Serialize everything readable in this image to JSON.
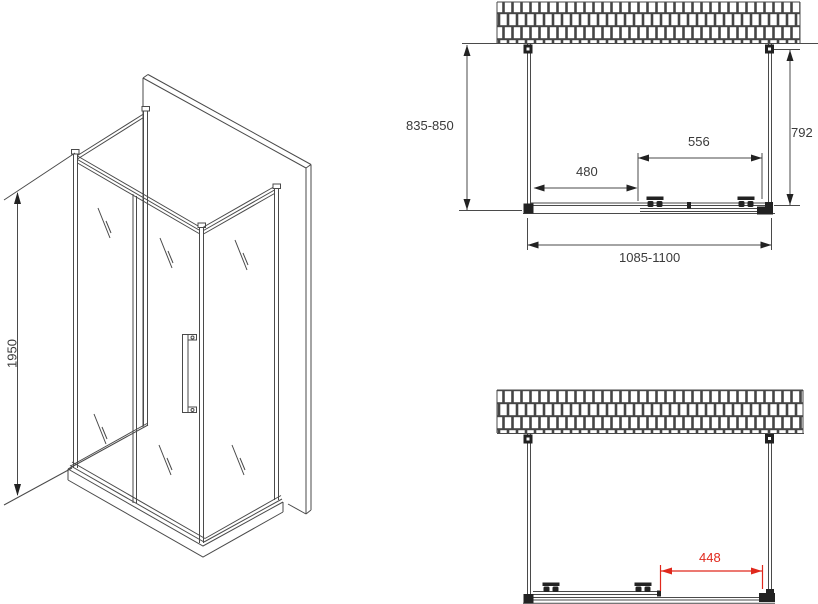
{
  "colors": {
    "line": "#4a4a4a",
    "dark": "#222222",
    "dimension_red": "#e0281c",
    "text": "#3a3a3a",
    "background": "#ffffff"
  },
  "isometric_view": {
    "height_label": "1950"
  },
  "plan_view_top": {
    "depth_label": "835-850",
    "right_depth_label": "792",
    "door_width_label": "556",
    "fixed_panel_width_label": "480",
    "total_width_label": "1085-1100"
  },
  "plan_view_bottom": {
    "opening_width_label": "448"
  }
}
